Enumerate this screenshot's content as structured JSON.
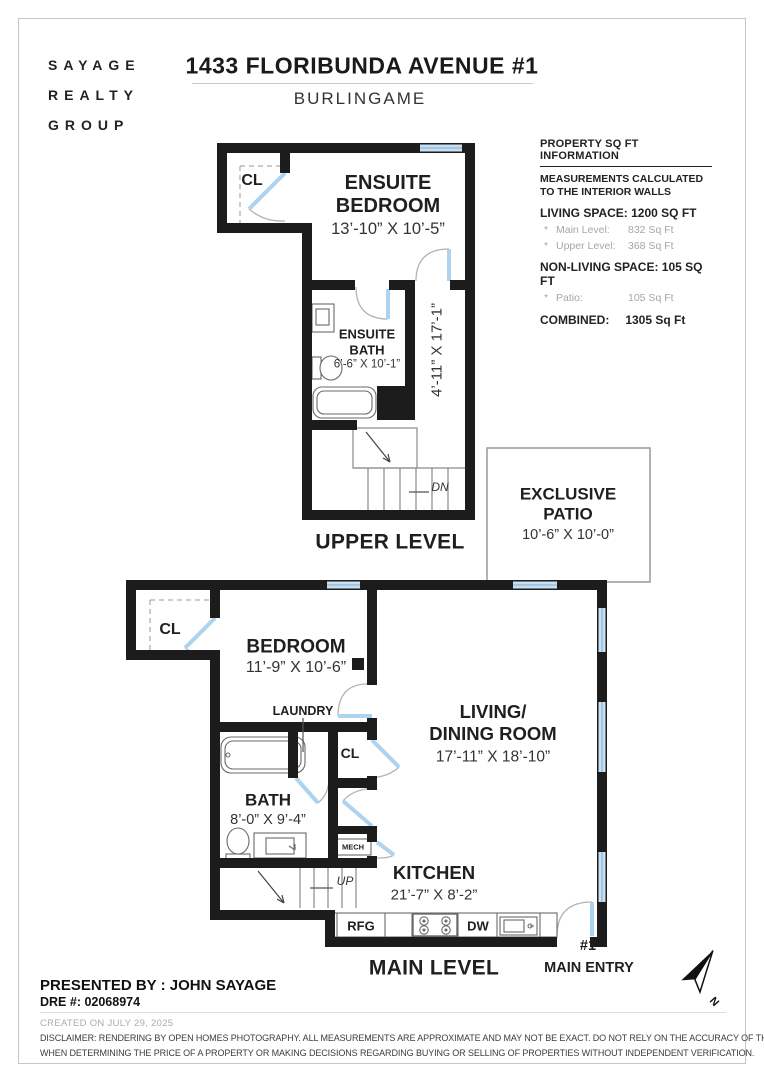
{
  "header": {
    "logo_lines": [
      "SAYAGE",
      "REALTY",
      "GROUP"
    ],
    "title": "1433 FLORIBUNDA AVENUE #1",
    "subtitle": "BURLINGAME"
  },
  "info_panel": {
    "title": "PROPERTY SQ FT INFORMATION",
    "note_line1": "MEASUREMENTS CALCULATED",
    "note_line2": "TO THE INTERIOR WALLS",
    "living_space": "LIVING SPACE: 1200 SQ FT",
    "living_items": [
      {
        "bullet": "*",
        "label": "Main Level:",
        "value": "832 Sq Ft"
      },
      {
        "bullet": "*",
        "label": "Upper Level:",
        "value": "368 Sq Ft"
      }
    ],
    "non_living": "NON-LIVING SPACE: 105 SQ FT",
    "non_living_items": [
      {
        "bullet": "*",
        "label": "Patio:",
        "value": "105 Sq Ft"
      }
    ],
    "combined_label": "COMBINED:",
    "combined_value": "1305  Sq Ft"
  },
  "upper_plan": {
    "closet": "CL",
    "bedroom_line1": "ENSUITE",
    "bedroom_line2": "BEDROOM",
    "bedroom_dims": "13’-10” X 10’-5”",
    "bath_line1": "ENSUITE",
    "bath_line2": "BATH",
    "bath_dims": "6’-6” X 10’-1”",
    "hall_dims": "4’-11” X 17’-1”",
    "stairs_label": "DN",
    "level_label": "UPPER LEVEL"
  },
  "patio": {
    "line1": "EXCLUSIVE",
    "line2": "PATIO",
    "dims": "10’-6” X 10’-0”"
  },
  "main_plan": {
    "closet": "CL",
    "bedroom": "BEDROOM",
    "bedroom_dims": "11’-9” X 10’-6”",
    "laundry": "LAUNDRY",
    "closet2": "CL",
    "living_line1": "LIVING/",
    "living_line2": "DINING ROOM",
    "living_dims": "17’-11” X 18’-10”",
    "bath": "BATH",
    "bath_dims": "8’-0” X 9’-4”",
    "mech": "MECH",
    "stairs_label": "UP",
    "kitchen": "KITCHEN",
    "kitchen_dims": "21’-7” X 8’-2”",
    "rfg": "RFG",
    "dw": "DW",
    "unit": "#1",
    "entry": "MAIN ENTRY",
    "level_label": "MAIN LEVEL"
  },
  "compass": {
    "north": "N"
  },
  "footer": {
    "presented_by": "PRESENTED BY : JOHN SAYAGE",
    "dre": "DRE #: 02068974",
    "created": "CREATED ON JULY 29, 2025",
    "disclaimer_line1": "DISCLAIMER: RENDERING BY OPEN HOMES PHOTOGRAPHY. ALL MEASUREMENTS ARE APPROXIMATE AND MAY NOT BE EXACT. DO NOT RELY ON THE ACCURACY OF THIS FLOOR PLAN",
    "disclaimer_line2": "WHEN DETERMINING THE PRICE OF A PROPERTY OR MAKING DECISIONS REGARDING BUYING OR SELLING OF PROPERTIES WITHOUT INDEPENDENT VERIFICATION."
  },
  "colors": {
    "wall": "#1c1c1c",
    "window": "#c8dff2",
    "door_leaf": "#aed3ee",
    "fixture": "#6a6a6a",
    "muted_text": "#a6a6a6"
  }
}
